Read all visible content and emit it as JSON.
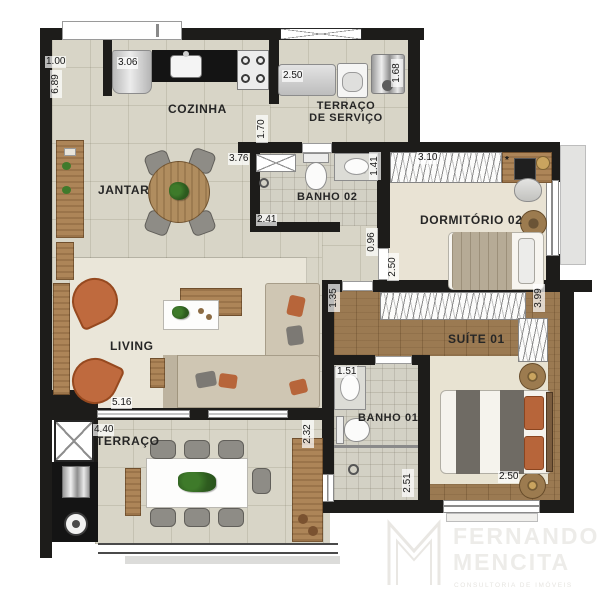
{
  "rooms": {
    "cozinha": "COZINHA",
    "terraco_servico_l1": "TERRAÇO",
    "terraco_servico_l2": "DE SERVIÇO",
    "jantar": "JANTAR",
    "banho02": "BANHO 02",
    "dormitorio02": "DORMITÓRIO 02",
    "suite01": "SUÍTE 01",
    "living": "LIVING",
    "banho01": "BANHO 01",
    "terraco": "TERRAÇO"
  },
  "dimensions": {
    "entry_offset": "1.00",
    "left_wall": "6.89",
    "fridge_nook": "3.06",
    "laundry_counter": "2.50",
    "water_heater": "1.68",
    "kitchen_passage": "1.70",
    "jantar_wall": "3.76",
    "banho02_counter": "1.41",
    "banho02_width": "2.41",
    "dorm02_wardrobe": "3.10",
    "hall_passage": "0.96",
    "dorm02_depth": "2.50",
    "suite_entry": "1.35",
    "suite_wardrobe": "3.99",
    "banho01_counter": "1.51",
    "living_width": "5.16",
    "terraco_width": "4.40",
    "terraco_depth": "2.32",
    "banho01_shower": "2.51",
    "suite_bed": "2.50",
    "note_marker": "*"
  },
  "logo": {
    "line1": "FERNANDO",
    "line2": "MENCITA",
    "tagline": "consultoria de imóveis"
  }
}
